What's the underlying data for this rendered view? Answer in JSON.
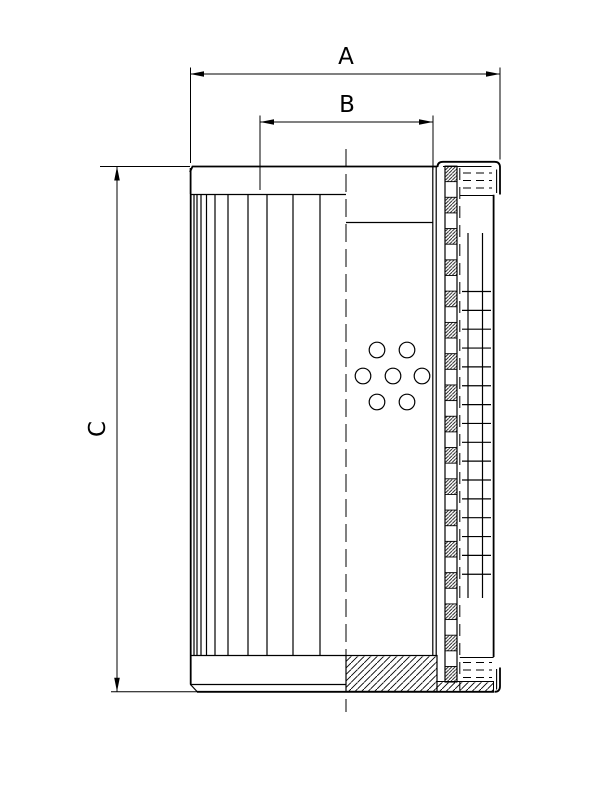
{
  "page": {
    "background": "#ffffff",
    "ink": "#000000"
  },
  "drawing_type": "filter-element-half-section",
  "dimensions": {
    "a": {
      "label": "A",
      "orientation": "horizontal",
      "position": "top-outer"
    },
    "b": {
      "label": "B",
      "orientation": "horizontal",
      "position": "top-inner"
    },
    "c": {
      "label": "C",
      "orientation": "vertical",
      "position": "left"
    }
  },
  "geometry": {
    "pleats": {
      "x": [
        194,
        197,
        201,
        206.5,
        215,
        228,
        248,
        267,
        293,
        320
      ],
      "y1": 195,
      "y2": 655
    },
    "core_squares": {
      "x": 445,
      "width": 12,
      "y_start": 166,
      "count": 33,
      "square_h": 15.64
    },
    "mesh": {
      "verticals": [
        468,
        482.5
      ],
      "v_y1": 233,
      "v_y2": 598,
      "h_x1": 462,
      "h_x2": 491,
      "h_y_start": 291.5,
      "h_step": 18.85,
      "h_count": 16
    },
    "holes": {
      "r": 7.8,
      "centers": [
        [
          377,
          350
        ],
        [
          407,
          350
        ],
        [
          363,
          376
        ],
        [
          393,
          376
        ],
        [
          422,
          376
        ],
        [
          377,
          402
        ],
        [
          407,
          402
        ]
      ]
    },
    "seals": {
      "x1": 463,
      "x2": 492,
      "top_rows": [
        173,
        180.5,
        188
      ],
      "bottom_rows": [
        662.5,
        670,
        677.5
      ]
    },
    "centerline": {
      "x": 346,
      "y1": 149,
      "y2": 712
    },
    "perf_dashed_line": {
      "x": 459.8,
      "y1": 168,
      "y2": 690
    }
  }
}
